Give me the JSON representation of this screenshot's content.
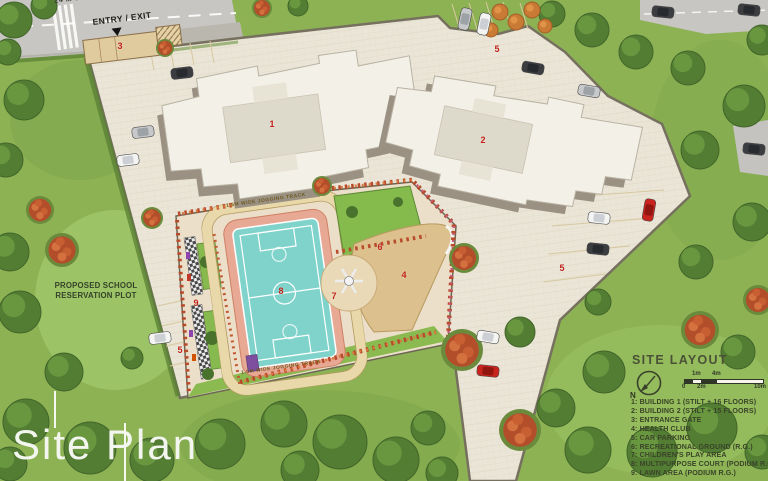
{
  "title": "Site Plan",
  "road": {
    "name": "24 M WIDE ROAD",
    "entry_exit": "ENTRY / EXIT"
  },
  "annotations": {
    "school_line1": "PROPOSED SCHOOL",
    "school_line2": "RESERVATION PLOT",
    "jogging_track": "1.5M WIDE JOGGING TRACK"
  },
  "markers": {
    "building1": "1",
    "building2": "2",
    "entrance_gate": "3",
    "health_club": "4",
    "parking_a": "5",
    "parking_b": "5",
    "parking_c": "5",
    "recreational_ground": "6",
    "childrens_play": "7",
    "multipurpose_court": "8",
    "lawn_area": "9"
  },
  "legend": {
    "title": "SITE LAYOUT",
    "north": "N",
    "scale": {
      "m1": "1m",
      "m4": "4m",
      "zero": "0",
      "m2": "2m",
      "m10": "10m"
    },
    "items": [
      "1: BUILDING 1 (STILT + 16 FLOORS)",
      "2: BUILDING 2 (STILT + 15 FLOORS)",
      "3: ENTRANCE GATE",
      "4: HEALTH CLUB",
      "5: CAR PARKING",
      "6: RECREATIONAL GROUND (R.G.)",
      "7: CHILDREN'S PLAY AREA",
      "8: MULTIPURPOSE COURT (PODIUM R.G.)",
      "9: LAWN AREA (PODIUM R.G.)"
    ]
  },
  "colors": {
    "marker_red": "#c0231c",
    "court_teal": "#7fd3cb",
    "court_border_pink": "#e7a894",
    "lawn_green": "#85ba4d",
    "pavement": "#eae5d7",
    "road_gray": "#c7c6c2"
  }
}
